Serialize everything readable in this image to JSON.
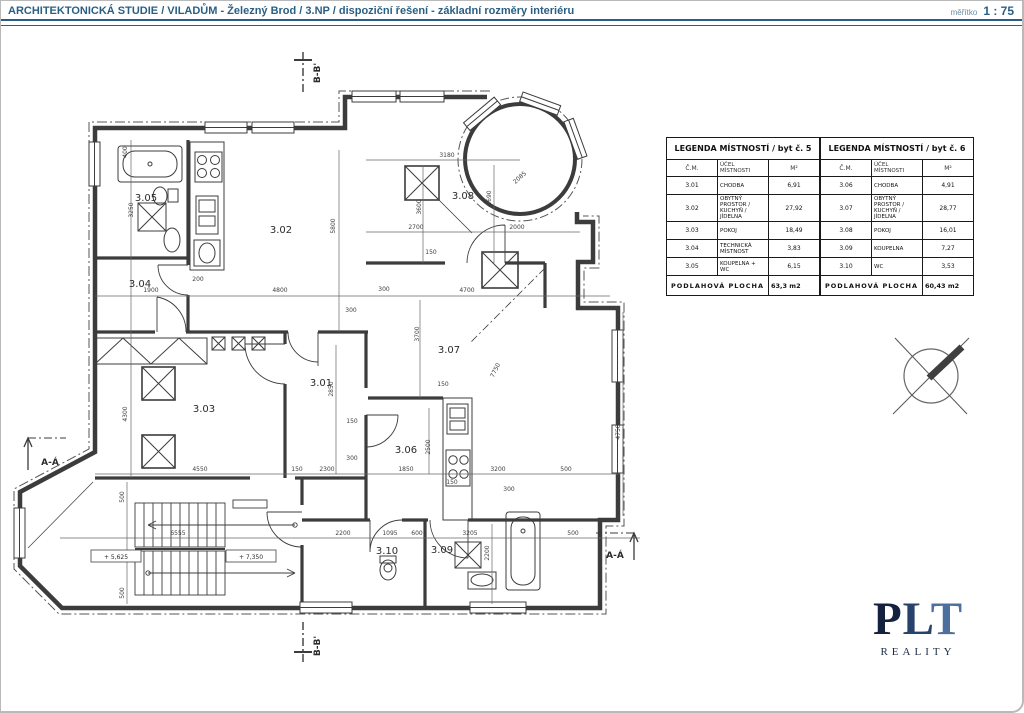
{
  "header": {
    "title": "ARCHITEKTONICKÁ STUDIE / VILADŮM - Železný Brod / 3.NP / dispoziční řešení - základní rozměry interiéru",
    "scale_label": "měřítko",
    "scale_value": "1 : 75"
  },
  "legend_tables": [
    {
      "title": "LEGENDA MÍSTNOSTÍ / byt č. 5",
      "columns": [
        "Č.M.",
        "ÚČEL MÍSTNOSTI",
        "M²"
      ],
      "rows": [
        [
          "3.01",
          "CHODBA",
          "6,91"
        ],
        [
          "3.02",
          "OBYTNÝ PROSTOR / KUCHYŇ / JÍDELNA",
          "27,92"
        ],
        [
          "3.03",
          "POKOJ",
          "18,49"
        ],
        [
          "3.04",
          "TECHNICKÁ MÍSTNOST",
          "3,83"
        ],
        [
          "3.05",
          "KOUPELNA + WC",
          "6,15"
        ]
      ],
      "footer_label": "PODLAHOVÁ PLOCHA",
      "footer_value": "63,3 m2"
    },
    {
      "title": "LEGENDA MÍSTNOSTÍ / byt č. 6",
      "columns": [
        "Č.M.",
        "ÚČEL MÍSTNOSTI",
        "M²"
      ],
      "rows": [
        [
          "3.06",
          "CHODBA",
          "4,91"
        ],
        [
          "3.07",
          "OBYTNÝ PROSTOR / KUCHYŇ / JÍDELNA",
          "28,77"
        ],
        [
          "3.08",
          "POKOJ",
          "16,01"
        ],
        [
          "3.09",
          "KOUPELNA",
          "7,27"
        ],
        [
          "3.10",
          "WC",
          "3,53"
        ]
      ],
      "footer_label": "PODLAHOVÁ PLOCHA",
      "footer_value": "60,43 m2"
    }
  ],
  "plan": {
    "rooms": [
      [
        "3.01",
        321,
        386
      ],
      [
        "3.02",
        281,
        233
      ],
      [
        "3.03",
        204,
        412
      ],
      [
        "3.04",
        140,
        287
      ],
      [
        "3.05",
        146,
        201
      ],
      [
        "3.06",
        406,
        453
      ],
      [
        "3.07",
        449,
        353
      ],
      [
        "3.08",
        463,
        199
      ],
      [
        "3.09",
        442,
        553
      ],
      [
        "3.10",
        387,
        554
      ]
    ],
    "dim_labels": [
      [
        "3180",
        447,
        157,
        0
      ],
      [
        "2085",
        521,
        179,
        -42
      ],
      [
        "2690",
        491,
        198,
        -90
      ],
      [
        "3600",
        421,
        207,
        -90
      ],
      [
        "2700",
        416,
        229,
        0
      ],
      [
        "2000",
        517,
        229,
        0
      ],
      [
        "150",
        431,
        254,
        0
      ],
      [
        "5800",
        335,
        226,
        -90
      ],
      [
        "400",
        127,
        152,
        -90
      ],
      [
        "3250",
        133,
        210,
        -90
      ],
      [
        "200",
        198,
        281,
        0
      ],
      [
        "1900",
        151,
        292,
        0
      ],
      [
        "4800",
        280,
        292,
        0
      ],
      [
        "300",
        384,
        291,
        0
      ],
      [
        "4700",
        467,
        292,
        0
      ],
      [
        "300",
        351,
        312,
        0
      ],
      [
        "3700",
        419,
        334,
        -90
      ],
      [
        "7750",
        497,
        371,
        -64
      ],
      [
        "2850",
        333,
        389,
        -90
      ],
      [
        "4300",
        127,
        414,
        -90
      ],
      [
        "150",
        352,
        423,
        0
      ],
      [
        "300",
        352,
        460,
        0
      ],
      [
        "150",
        443,
        386,
        0
      ],
      [
        "2500",
        430,
        447,
        -90
      ],
      [
        "4550",
        200,
        471,
        0
      ],
      [
        "150",
        297,
        471,
        0
      ],
      [
        "2300",
        327,
        471,
        0
      ],
      [
        "1850",
        406,
        471,
        0
      ],
      [
        "3200",
        498,
        471,
        0
      ],
      [
        "500",
        566,
        471,
        0
      ],
      [
        "150",
        452,
        484,
        0
      ],
      [
        "300",
        509,
        491,
        0
      ],
      [
        "6555",
        178,
        535,
        0
      ],
      [
        "2200",
        343,
        535,
        0
      ],
      [
        "1095",
        390,
        535,
        0
      ],
      [
        "600",
        417,
        535,
        0
      ],
      [
        "3205",
        470,
        535,
        0
      ],
      [
        "500",
        573,
        535,
        0
      ],
      [
        "2200",
        489,
        553,
        -90
      ],
      [
        "500",
        124,
        497,
        -90
      ],
      [
        "500",
        124,
        593,
        -90
      ],
      [
        "4750",
        620,
        432,
        -90
      ]
    ],
    "levels": [
      [
        "+ 5,625",
        116,
        559
      ],
      [
        "+ 7,350",
        251,
        559
      ]
    ],
    "sections": [
      [
        "B-B'",
        320,
        73,
        -90
      ],
      [
        "B-B'",
        320,
        646,
        -90
      ],
      [
        "A-Á",
        50,
        465,
        0
      ],
      [
        "A-Á",
        615,
        558,
        0
      ]
    ]
  },
  "logo": {
    "text": "PLT",
    "subtitle": "REALITY",
    "letter_colors": [
      "#15223f",
      "#27426b",
      "#4d6f9e"
    ]
  },
  "colors": {
    "header_text": "#2a5f84",
    "line": "#3c3c3c",
    "dim_line": "#666666"
  }
}
